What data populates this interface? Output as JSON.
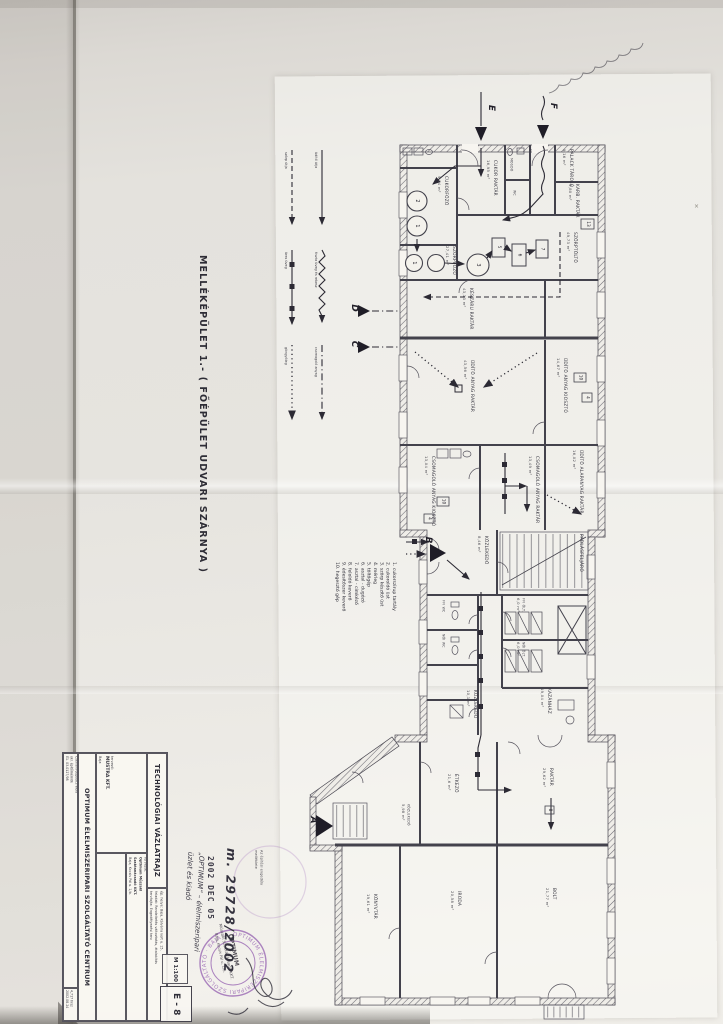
{
  "page": {
    "plan_title": "MELLÉKÉPÜLET 1.- ( FŐÉPÜLET UDVARI SZÁRNYA )",
    "paper_color": "#e7e5e0",
    "ink_color": "#3f3e47",
    "stamp_purple": "#9a68b4"
  },
  "flow_legend": {
    "items": [
      {
        "style": "dashed",
        "label": "szörp útja"
      },
      {
        "style": "solid",
        "label": "üdítő útja"
      },
      {
        "style": "ticked",
        "label": "üres üveg"
      },
      {
        "style": "wavy",
        "label": "tiszta üveg és rekesz"
      },
      {
        "style": "dotted",
        "label": "göngyöleg"
      },
      {
        "style": "dashdot",
        "label": "csomagoló anyag"
      }
    ]
  },
  "equipment_legend": {
    "items": [
      {
        "num": "1.",
        "label": "cukorszirup tartály"
      },
      {
        "num": "2.",
        "label": "cukoroldó üst"
      },
      {
        "num": "3.",
        "label": "szörp készítő üst"
      },
      {
        "num": "4.",
        "label": "mérleg"
      },
      {
        "num": "5.",
        "label": "töltőgép"
      },
      {
        "num": "6.",
        "label": "asztal - dugózó"
      },
      {
        "num": "7.",
        "label": "asztal - címkéző"
      },
      {
        "num": "8.",
        "label": "feloldó keverő"
      },
      {
        "num": "9.",
        "label": "édesítőszer keverő"
      },
      {
        "num": "10.",
        "label": "hegesztő gép"
      }
    ]
  },
  "rooms": [
    {
      "name": "CUKORFŐZŐ",
      "area": "9,04 m²"
    },
    {
      "name": "CUKOR RAKTÁR",
      "area": "16,95 m²"
    },
    {
      "name": "MOSDÓ",
      "area": ""
    },
    {
      "name": "WC",
      "area": ""
    },
    {
      "name": "PALACK TÁROLÓ",
      "area": "9,16 m²"
    },
    {
      "name": "KARB. RAKTÁR",
      "area": "5,80 m²"
    },
    {
      "name": "SZÖRPFŐZŐ",
      "area": "27,41 m²"
    },
    {
      "name": "SZÖRPTÖLTŐ",
      "area": "49,73 m²"
    },
    {
      "name": "KÉSZÁRU RAKTÁR",
      "area": "43,13 m²"
    },
    {
      "name": "ÜDÍTŐ ANYAG RAKTÁR",
      "area": "43,56 m²"
    },
    {
      "name": "ÜDÍTŐ ANYAG KIOSZTÓ",
      "area": "14,67 m²"
    },
    {
      "name": "CSOMAGOLÓ ANYAG KIOSZTÓ",
      "area": "13,04 m²"
    },
    {
      "name": "CSOMAGOLÓ ANYAG RAKTÁR",
      "area": "13,49 m²"
    },
    {
      "name": "ÜDÍTŐ ALAPANYAG RAKTÁR",
      "area": "16,02 m²"
    },
    {
      "name": "KÖZLEKEDŐ",
      "area": "8,46 m²"
    },
    {
      "name": "PADLÁSFELJÁRÓ",
      "area": ""
    },
    {
      "name": "FFI ÖLT.",
      "area": "6,0 m²"
    },
    {
      "name": "NŐI ÖLT.",
      "area": "6,0 m²"
    },
    {
      "name": "FFI WC",
      "area": ""
    },
    {
      "name": "NŐI WC",
      "area": ""
    },
    {
      "name": "KÖZLEKEDŐ",
      "area": "10,1 m²"
    },
    {
      "name": "KAZÁNHÁZ",
      "area": "19,04 m²"
    },
    {
      "name": "RAKTÁR",
      "area": "29,62 m²"
    },
    {
      "name": "ÉTKEZŐ",
      "area": "21,6 m²"
    },
    {
      "name": "KÖZLEKEDŐ",
      "area": "5,98 m²"
    },
    {
      "name": "BOLT",
      "area": "21,77 m²"
    },
    {
      "name": "IRODA",
      "area": "20,58 m²"
    },
    {
      "name": "KÖNYVTÁR",
      "area": "19,61 m²"
    }
  ],
  "markers": {
    "a": "A",
    "b": "B",
    "c": "C",
    "d": "D",
    "e": "E",
    "f": "F"
  },
  "tags": {
    "n1": "1",
    "n2": "2",
    "n3": "3",
    "n4": "4",
    "n5": "5",
    "n6": "6",
    "n7": "7",
    "n8": "8",
    "n10": "10",
    "n13": "13"
  },
  "title_block": {
    "drawing_type": "TECHNOLÓGIAI VÁZLATRAJZ",
    "project": "OPTIMUM ÉLELMISZERIPARI SZOLGÁLTATÓ CENTRUM",
    "tervezo_label": "tervező:",
    "tervezo_firm": "MUSTRA KFT.",
    "tervezo_city": "Baja",
    "megbizo_label": "tervezte:",
    "megbizo_name": "Optimum Műszaki",
    "megbizo_name2": "Szaktanácsadó KKT.",
    "megbizo_addr": "Baja, Kocsis Pál u. 1/b.",
    "felelos_label": "felelős terv.:",
    "felelos_name": "Cserfalvi-Jegodics Viola",
    "felelos_qual": "okl. építőmérnök",
    "felelos_reg": "É1. 03-0127/98",
    "site_label": "ép. helye:",
    "site_value": "Baja, Kálvária kert u. 15.",
    "task_label": "feladat:",
    "task_value": "Rendeltetés változtatás, átalakítás",
    "plantype_label": "tervfajta:",
    "plantype_value": "Engedélyezési terv",
    "scale": "M 1:100",
    "sheet_no": "E - 8",
    "parcel": "4,717 hrsz",
    "date": "2002.08.24"
  },
  "stamp": {
    "file_number": "m. 29728/2002",
    "date_received": "2002 DEC 05",
    "note_line1": "Az építési engedély",
    "note_line2": "melléklete",
    "hand_line1": "„OPTIMUM” – élelmiszeripari",
    "hand_line2": "üzlet és kiadó",
    "round_text": "OPTIMUM ÉLELMISZERIPARI SZOLGÁLTATÓ · BAJA ·",
    "firm_line1": "OPTIMUM",
    "firm_line2": "Műszaki Szaktanácsadó KKT.",
    "firm_line3": "Baja, Kocsis Pál u. 1/b."
  },
  "artifacts": {
    "pencil_mark": "×"
  }
}
